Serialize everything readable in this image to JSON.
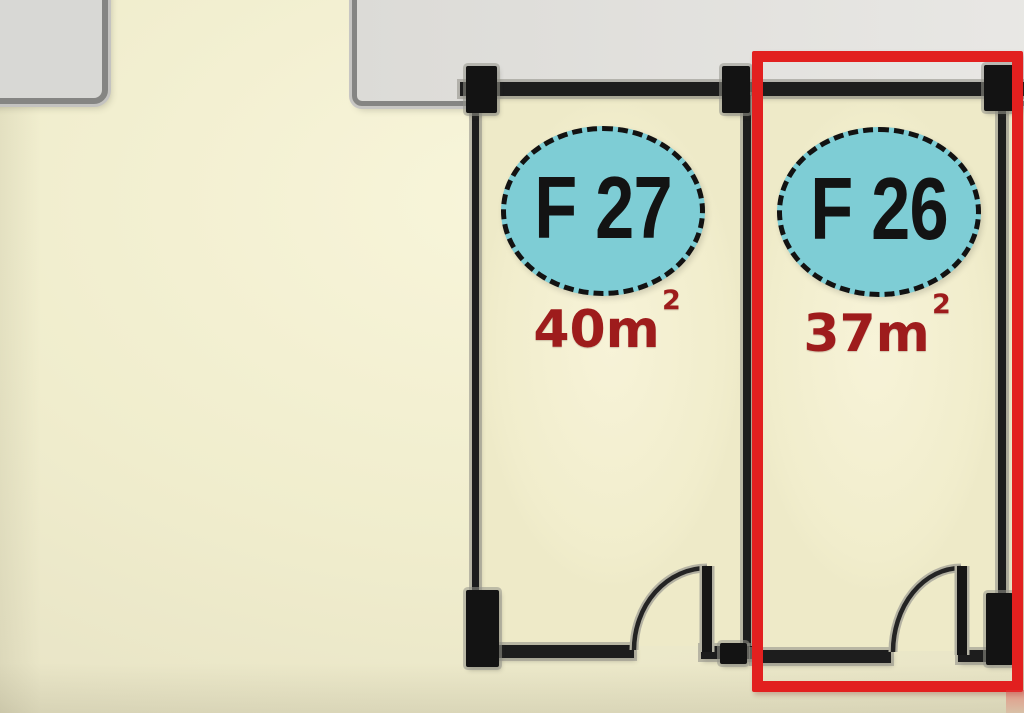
{
  "floorplan": {
    "units": [
      {
        "code": "F 27",
        "area_value": "40m",
        "area_sup": "2",
        "area_text": "40m²",
        "highlighted": false
      },
      {
        "code": "F 26",
        "area_value": "37m",
        "area_sup": "2",
        "area_text": "37m²",
        "highlighted": true
      }
    ],
    "highlight": {
      "unit_code": "F 26",
      "color": "#e2201f"
    },
    "colors": {
      "floor_fill": "#f0edcd",
      "room_fill": "#f2eecd",
      "tag_ellipse_fill": "#7ecdd5",
      "tag_text": "#131313",
      "area_text": "#9e1c1c",
      "wall": "#1d1d1d",
      "concrete_fill": "#d8d8d5",
      "concrete_border": "#858583"
    }
  }
}
